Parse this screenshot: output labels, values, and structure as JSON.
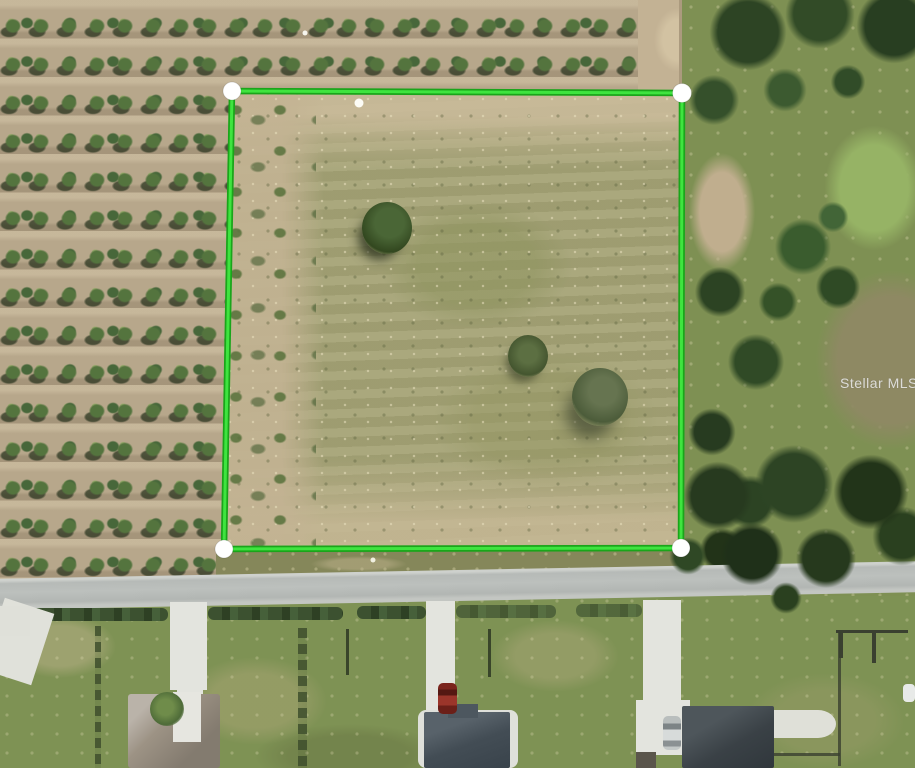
{
  "watermark": {
    "text": "Stellar MLS"
  },
  "overlay": {
    "type": "property-boundary",
    "boundary_color_outer": "#1aa51a",
    "boundary_color_inner": "#3fe43f",
    "corner_marker_color": "#ffffff",
    "corners_px": [
      [
        232,
        91
      ],
      [
        682,
        93
      ],
      [
        681,
        548
      ],
      [
        224,
        549
      ]
    ],
    "extra_dots_px": [
      [
        359,
        103
      ],
      [
        305,
        33
      ],
      [
        373,
        560
      ]
    ]
  },
  "scene": {
    "type": "aerial-photo",
    "description": "Aerial view of a vacant land parcel outlined in green, bordered by a citrus orchard on the left, wooded pasture on the right, and a residential street with homes below",
    "features": [
      "citrus-orchard-rows",
      "outlined-vacant-parcel",
      "dirt-path",
      "wooded-area",
      "mowed-field",
      "paved-road",
      "hedgerow",
      "driveways",
      "house-gray-roof",
      "house-slate-roof",
      "house-charcoal-roof",
      "red-car",
      "silver-car",
      "fences"
    ]
  }
}
